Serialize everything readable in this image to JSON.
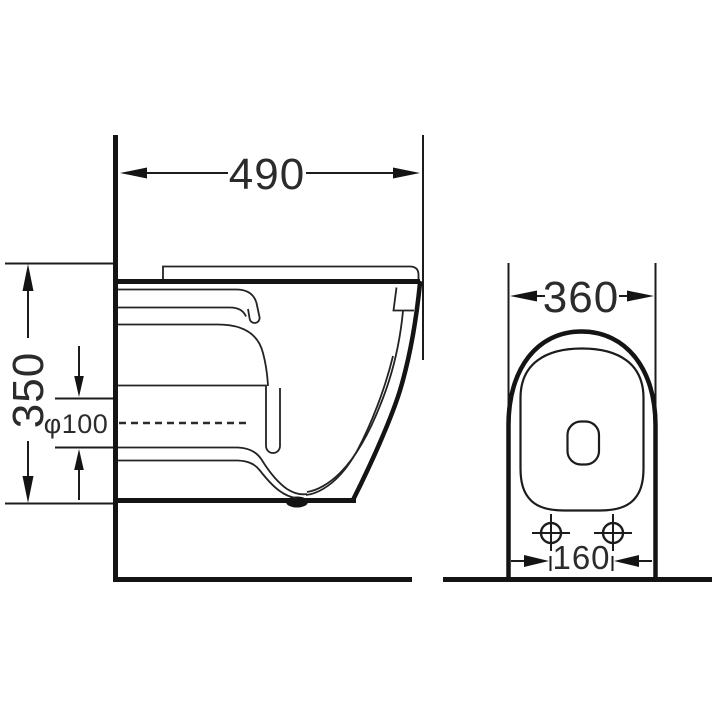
{
  "drawing": {
    "kind": "toilet-installation-dimension-drawing",
    "background_color": "#ffffff",
    "line_color": "#141414",
    "text_color": "#2b2b2b"
  },
  "dimensions": {
    "depth": "490",
    "height": "350",
    "outlet_diameter": "φ100",
    "width": "360",
    "bolt_spacing": "160"
  }
}
